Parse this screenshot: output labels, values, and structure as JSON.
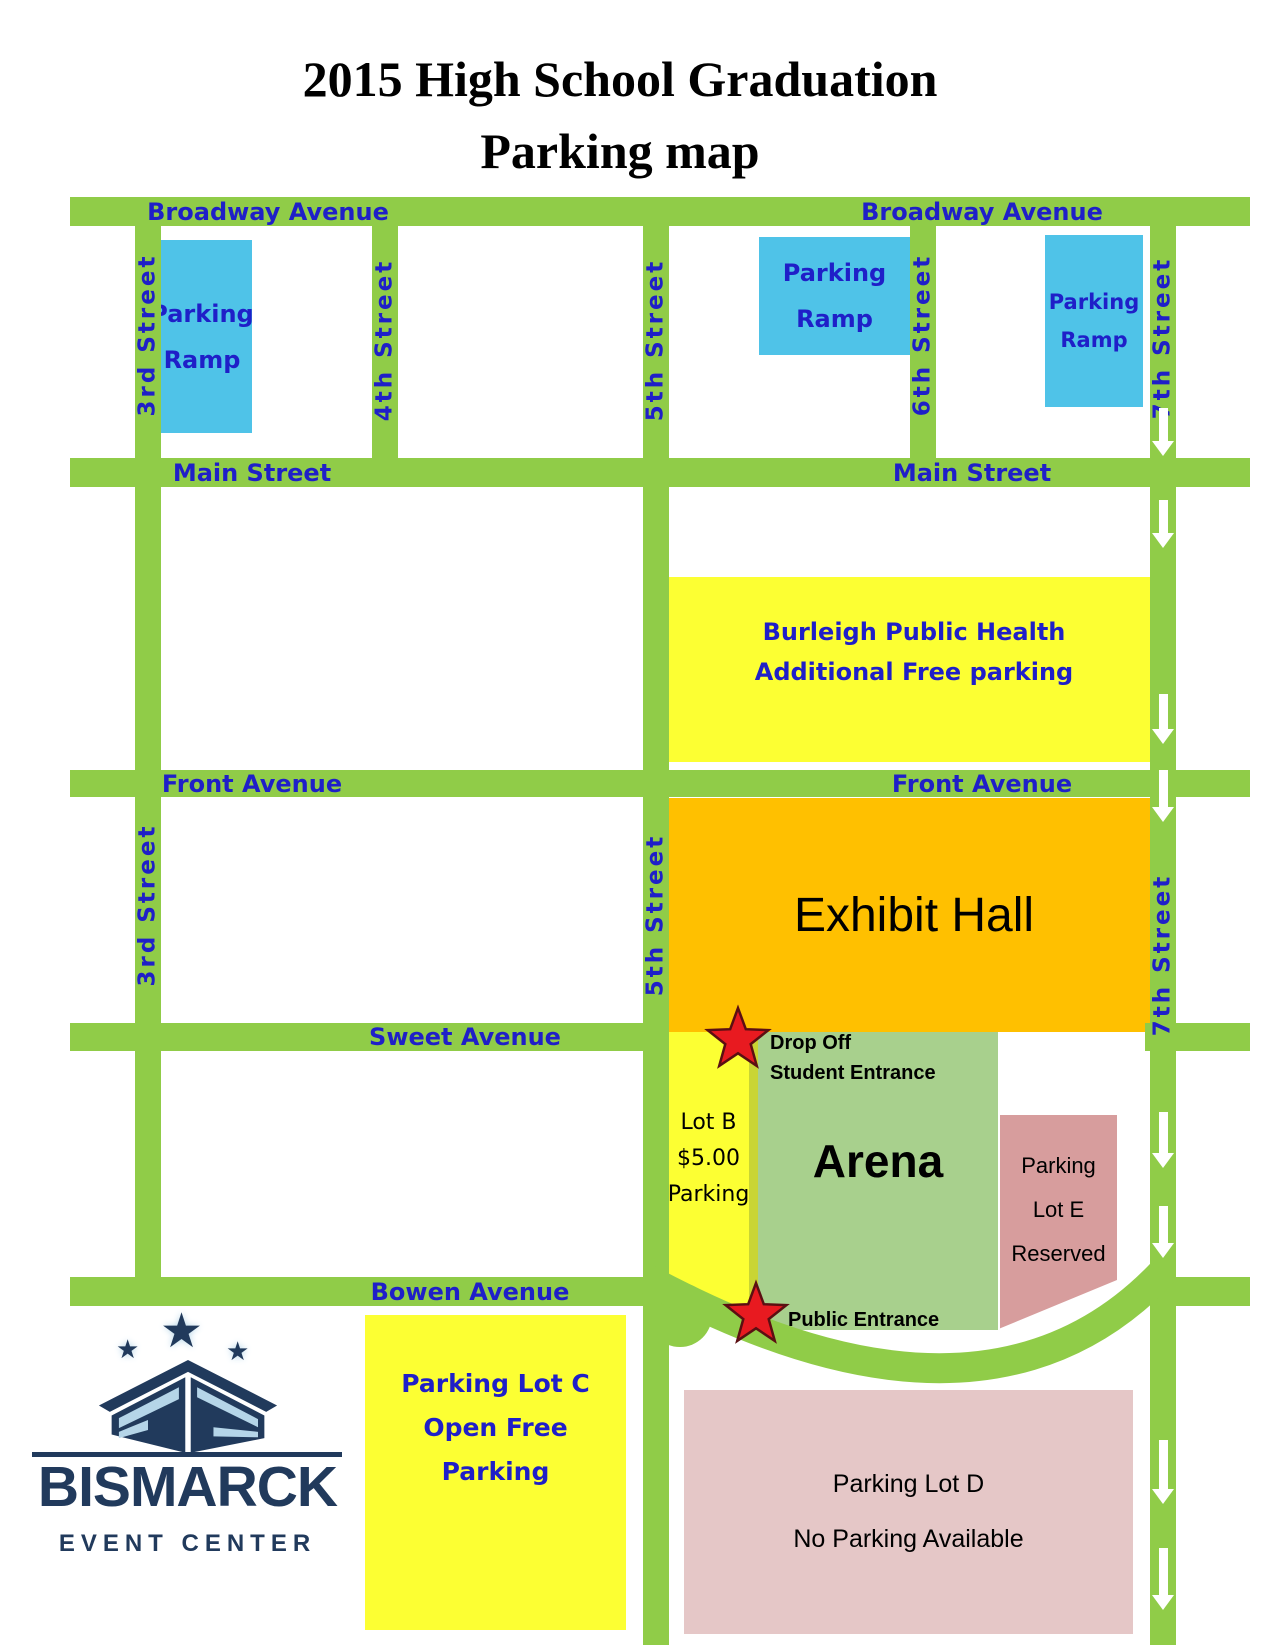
{
  "title": {
    "line1": "2015 High School Graduation",
    "line2": "Parking map"
  },
  "colors": {
    "street_green": "#90CC48",
    "label_blue": "#1F1FC8",
    "ramp_blue": "#4FC3E8",
    "lot_yellow": "#FCFF33",
    "exhibit_orange": "#FFC000",
    "arena_green": "#A8D08D",
    "lot_e_pink": "#D79D9D",
    "lot_d_pink": "#E5C7C7",
    "star_red": "#E81A20",
    "arrow_white": "#FFFFFF",
    "logo_navy": "#213A5C",
    "logo_lightblue": "#B5D5E8"
  },
  "street_labels": {
    "broadway_left": "Broadway Avenue",
    "broadway_right": "Broadway Avenue",
    "main_left": "Main Street",
    "main_right": "Main Street",
    "front_left": "Front Avenue",
    "front_right": "Front Avenue",
    "sweet": "Sweet Avenue",
    "bowen": "Bowen Avenue",
    "third_upper": "3rd Street",
    "third_lower": "3rd Street",
    "fourth": "4th Street",
    "fifth_upper": "5th Street",
    "fifth_lower": "5th Street",
    "sixth": "6th Street",
    "seventh_upper": "7th Street",
    "seventh_lower": "7th Street"
  },
  "buildings": {
    "ramp1": {
      "line1": "Parking",
      "line2": "Ramp"
    },
    "ramp2": {
      "line1": "Parking",
      "line2": "Ramp"
    },
    "ramp3": {
      "line1": "Parking",
      "line2": "Ramp"
    },
    "burleigh": {
      "line1": "Burleigh Public Health",
      "line2": "Additional Free parking"
    },
    "exhibit_hall": {
      "label": "Exhibit Hall"
    },
    "arena": {
      "label": "Arena"
    },
    "lot_b": {
      "line1": "Lot B",
      "line2": "$5.00",
      "line3": "Parking"
    },
    "lot_e": {
      "line1": "Parking",
      "line2": "Lot E",
      "line3": "Reserved"
    },
    "lot_c": {
      "line1": "Parking Lot C",
      "line2": "Open Free",
      "line3": "Parking"
    },
    "lot_d": {
      "line1": "Parking Lot D",
      "line2": "No Parking Available"
    }
  },
  "markers": {
    "drop_off": {
      "line1": "Drop Off",
      "line2": "Student Entrance"
    },
    "public_entrance": {
      "label": "Public Entrance"
    }
  },
  "logo": {
    "name": "BISMARCK",
    "subtitle": "EVENT CENTER",
    "star_glyph": "★"
  }
}
